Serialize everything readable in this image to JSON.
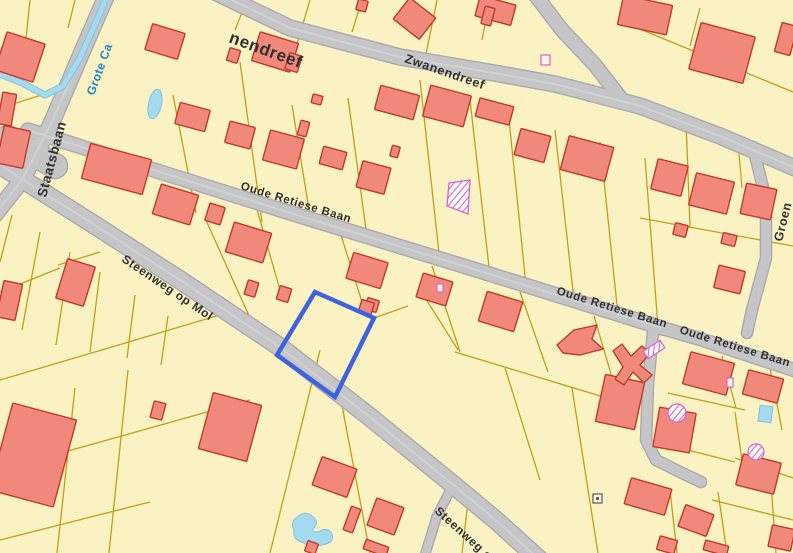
{
  "map": {
    "title": "Cadastral parcel map",
    "colors": {
      "background": "#FAF2C2",
      "parcel_line": "#C59E17",
      "road_fill": "#C5C5C7",
      "road_casing": "#A8A8AB",
      "road_centerline": "#D2D2D4",
      "building_fill": "#F0897B",
      "building_stroke": "#C23A2C",
      "water_fill": "#A5DAEE",
      "water_casing": "#7FC4E4",
      "selection": "#3E63DE",
      "hatch": "#DD5FD0",
      "road_label": "#303030",
      "water_label": "#1E86C8",
      "marker_stroke": "#555555"
    },
    "streets": {
      "names": [
        "Zwanendreef",
        "Staatsbaan",
        "Oude Retiese Baan",
        "Steenweg op Mol",
        "Groen",
        "Grote Ca"
      ],
      "waterway_name": "Grote Ca"
    },
    "roads": [
      {
        "name": "zwanendreef",
        "w": 15,
        "center": true,
        "pts": [
          [
            215,
            -8
          ],
          [
            290,
            28
          ],
          [
            400,
            57
          ],
          [
            500,
            74
          ],
          [
            555,
            84
          ],
          [
            640,
            106
          ],
          [
            720,
            136
          ],
          [
            800,
            170
          ]
        ]
      },
      {
        "name": "zwanendreef-spur",
        "w": 13,
        "center": false,
        "pts": [
          [
            533,
            -8
          ],
          [
            562,
            30
          ],
          [
            595,
            65
          ],
          [
            622,
            100
          ]
        ]
      },
      {
        "name": "staatsbaan",
        "w": 15,
        "center": true,
        "pts": [
          [
            108,
            -8
          ],
          [
            82,
            52
          ],
          [
            52,
            122
          ],
          [
            22,
            180
          ],
          [
            -8,
            218
          ]
        ]
      },
      {
        "name": "oude-retiese-baan-1",
        "w": 13,
        "center": true,
        "pts": [
          [
            28,
            130
          ],
          [
            160,
            172
          ],
          [
            300,
            216
          ],
          [
            470,
            268
          ],
          [
            560,
            296
          ],
          [
            662,
            328
          ]
        ]
      },
      {
        "name": "oude-retiese-baan-2",
        "w": 12,
        "center": false,
        "pts": [
          [
            662,
            328
          ],
          [
            700,
            339
          ],
          [
            800,
            372
          ]
        ]
      },
      {
        "name": "steenweg-op-mol",
        "w": 17,
        "center": true,
        "pts": [
          [
            3,
            167
          ],
          [
            90,
            222
          ],
          [
            180,
            280
          ],
          [
            280,
            347
          ],
          [
            370,
            417
          ],
          [
            445,
            478
          ],
          [
            498,
            522
          ],
          [
            542,
            562
          ]
        ]
      },
      {
        "name": "steenweg-spur",
        "w": 8,
        "center": false,
        "pts": [
          [
            452,
            487
          ],
          [
            437,
            516
          ],
          [
            424,
            558
          ]
        ]
      },
      {
        "name": "groen-road",
        "w": 10,
        "center": false,
        "pts": [
          [
            753,
            147
          ],
          [
            766,
            200
          ],
          [
            766,
            258
          ],
          [
            752,
            310
          ],
          [
            747,
            333
          ]
        ]
      },
      {
        "name": "south-branch",
        "w": 10,
        "center": false,
        "pts": [
          [
            653,
            331
          ],
          [
            648,
            385
          ],
          [
            646,
            440
          ],
          [
            656,
            460
          ],
          [
            680,
            472
          ],
          [
            701,
            482
          ]
        ]
      },
      {
        "name": "junction-patch",
        "w": 24,
        "center": false,
        "pts": [
          [
            8,
            138
          ],
          [
            55,
            166
          ]
        ]
      }
    ],
    "parcel_lines": [
      [
        247,
        0,
        235,
        30
      ],
      [
        310,
        0,
        297,
        44
      ],
      [
        362,
        0,
        352,
        32
      ],
      [
        437,
        0,
        426,
        54
      ],
      [
        490,
        0,
        482,
        40
      ],
      [
        632,
        0,
        624,
        24
      ],
      [
        700,
        8,
        690,
        46
      ],
      [
        618,
        20,
        793,
        92
      ],
      [
        752,
        38,
        745,
        62
      ],
      [
        30,
        0,
        24,
        58
      ],
      [
        75,
        0,
        68,
        28
      ],
      [
        0,
        58,
        26,
        50
      ],
      [
        0,
        108,
        64,
        88
      ],
      [
        173,
        95,
        196,
        213
      ],
      [
        240,
        62,
        262,
        222
      ],
      [
        292,
        105,
        312,
        228
      ],
      [
        348,
        98,
        368,
        244
      ],
      [
        420,
        80,
        440,
        262
      ],
      [
        470,
        100,
        490,
        276
      ],
      [
        508,
        110,
        526,
        285
      ],
      [
        555,
        130,
        574,
        300
      ],
      [
        600,
        142,
        618,
        315
      ],
      [
        645,
        158,
        658,
        327
      ],
      [
        686,
        122,
        690,
        227
      ],
      [
        738,
        142,
        742,
        188
      ],
      [
        640,
        218,
        793,
        246
      ],
      [
        205,
        218,
        250,
        318
      ],
      [
        256,
        206,
        280,
        290
      ],
      [
        340,
        232,
        362,
        302
      ],
      [
        374,
        318,
        408,
        306
      ],
      [
        424,
        296,
        458,
        350
      ],
      [
        432,
        266,
        460,
        352
      ],
      [
        520,
        292,
        548,
        372
      ],
      [
        594,
        316,
        618,
        398
      ],
      [
        455,
        352,
        640,
        408
      ],
      [
        505,
        368,
        540,
        480
      ],
      [
        572,
        388,
        598,
        553
      ],
      [
        668,
        393,
        745,
        410
      ],
      [
        668,
        445,
        735,
        462
      ],
      [
        710,
        358,
        715,
        393
      ],
      [
        735,
        412,
        742,
        460
      ],
      [
        722,
        356,
        736,
        408
      ],
      [
        770,
        368,
        782,
        430
      ],
      [
        712,
        500,
        793,
        520
      ],
      [
        670,
        490,
        677,
        553
      ],
      [
        718,
        492,
        727,
        553
      ],
      [
        770,
        470,
        776,
        553
      ],
      [
        735,
        458,
        793,
        478
      ],
      [
        12,
        215,
        0,
        262
      ],
      [
        40,
        232,
        22,
        330
      ],
      [
        70,
        252,
        56,
        345
      ],
      [
        100,
        272,
        90,
        352
      ],
      [
        135,
        295,
        127,
        358
      ],
      [
        168,
        316,
        161,
        365
      ],
      [
        0,
        380,
        230,
        312
      ],
      [
        0,
        470,
        250,
        400
      ],
      [
        75,
        388,
        57,
        553
      ],
      [
        128,
        370,
        109,
        553
      ],
      [
        320,
        350,
        270,
        553
      ],
      [
        340,
        395,
        370,
        553
      ],
      [
        468,
        502,
        462,
        553
      ],
      [
        0,
        540,
        150,
        502
      ],
      [
        0,
        292,
        60,
        268
      ],
      [
        58,
        265,
        100,
        252
      ]
    ],
    "buildings": [
      [
        148,
        28,
        34,
        27,
        17
      ],
      [
        255,
        37,
        40,
        30,
        17
      ],
      [
        287,
        54,
        13,
        17,
        17
      ],
      [
        228,
        49,
        11,
        13,
        17
      ],
      [
        398,
        5,
        33,
        27,
        38
      ],
      [
        477,
        0,
        37,
        21,
        15
      ],
      [
        620,
        0,
        50,
        30,
        12
      ],
      [
        694,
        29,
        56,
        48,
        15
      ],
      [
        483,
        7,
        10,
        18,
        15
      ],
      [
        778,
        24,
        16,
        30,
        15
      ],
      [
        357,
        0,
        10,
        11,
        15
      ],
      [
        654,
        162,
        31,
        31,
        14
      ],
      [
        692,
        177,
        39,
        33,
        14
      ],
      [
        743,
        186,
        31,
        31,
        12
      ],
      [
        674,
        224,
        13,
        12,
        14
      ],
      [
        722,
        234,
        14,
        11,
        14
      ],
      [
        716,
        268,
        27,
        23,
        14
      ],
      [
        85,
        151,
        63,
        36,
        15
      ],
      [
        177,
        106,
        31,
        22,
        15
      ],
      [
        227,
        124,
        26,
        22,
        15
      ],
      [
        266,
        134,
        35,
        31,
        15
      ],
      [
        321,
        149,
        24,
        18,
        15
      ],
      [
        359,
        164,
        29,
        27,
        15
      ],
      [
        299,
        121,
        9,
        15,
        15
      ],
      [
        391,
        146,
        8,
        11,
        15
      ],
      [
        312,
        95,
        10,
        9,
        15
      ],
      [
        377,
        90,
        40,
        25,
        15
      ],
      [
        426,
        90,
        42,
        32,
        15
      ],
      [
        477,
        102,
        35,
        19,
        15
      ],
      [
        517,
        132,
        31,
        27,
        15
      ],
      [
        564,
        141,
        46,
        35,
        15
      ],
      [
        156,
        189,
        39,
        31,
        17
      ],
      [
        207,
        205,
        16,
        18,
        17
      ],
      [
        229,
        227,
        39,
        31,
        17
      ],
      [
        246,
        281,
        11,
        15,
        17
      ],
      [
        349,
        257,
        36,
        27,
        17
      ],
      [
        366,
        299,
        12,
        12,
        17
      ],
      [
        419,
        277,
        31,
        25,
        17
      ],
      [
        482,
        296,
        37,
        31,
        17
      ],
      [
        600,
        378,
        40,
        48,
        12
      ],
      [
        686,
        357,
        45,
        33,
        15
      ],
      [
        745,
        374,
        36,
        25,
        15
      ],
      [
        656,
        410,
        37,
        40,
        10
      ],
      [
        739,
        458,
        39,
        32,
        14
      ],
      [
        627,
        483,
        42,
        27,
        16
      ],
      [
        681,
        509,
        30,
        23,
        20
      ],
      [
        658,
        538,
        18,
        14,
        16
      ],
      [
        704,
        543,
        24,
        10,
        15
      ],
      [
        770,
        527,
        23,
        22,
        12
      ],
      [
        205,
        398,
        50,
        58,
        15
      ],
      [
        152,
        402,
        12,
        17,
        15
      ],
      [
        316,
        462,
        37,
        30,
        20
      ],
      [
        347,
        507,
        10,
        25,
        20
      ],
      [
        371,
        502,
        29,
        29,
        20
      ],
      [
        364,
        543,
        24,
        10,
        20
      ],
      [
        306,
        542,
        11,
        11,
        20
      ],
      [
        0,
        37,
        40,
        40,
        18
      ],
      [
        0,
        128,
        27,
        38,
        12
      ],
      [
        61,
        262,
        29,
        41,
        17
      ],
      [
        0,
        282,
        19,
        37,
        12
      ],
      [
        0,
        410,
        66,
        90,
        15
      ],
      [
        0,
        93,
        14,
        32,
        10
      ],
      [
        278,
        287,
        12,
        14,
        17
      ],
      [
        360,
        301,
        13,
        12,
        17
      ]
    ],
    "building_polys": [
      {
        "name": "arrow-building",
        "points": "557,345 574,330 597,325 592,339 603,349 580,355 563,353"
      },
      {
        "name": "windmill-building",
        "points": "613,351 622,344 631,356 642,346 650,353 640,365 652,375 644,383 633,372 624,385 615,379 623,367"
      }
    ],
    "hatched_features": [
      {
        "type": "poly",
        "points": "449,183 470,180 468,214 447,206"
      },
      {
        "type": "rect",
        "x": 644,
        "y": 345,
        "w": 20,
        "h": 9,
        "rot": -33
      },
      {
        "type": "circle",
        "cx": 677,
        "cy": 413,
        "r": 9
      },
      {
        "type": "circle",
        "cx": 756,
        "cy": 452,
        "r": 8
      }
    ],
    "magenta_small": [
      [
        541,
        55,
        9,
        10
      ],
      [
        437,
        284,
        6,
        8
      ],
      [
        727,
        378,
        6,
        9
      ]
    ],
    "markers": [
      [
        593,
        494,
        9,
        9
      ]
    ],
    "water": {
      "streams": [
        [
          [
            108,
            -6
          ],
          [
            96,
            22
          ],
          [
            80,
            58
          ],
          [
            63,
            86
          ],
          [
            45,
            95
          ],
          [
            20,
            82
          ],
          [
            -6,
            72
          ]
        ]
      ],
      "pond_ellipse": {
        "cx": 155,
        "cy": 104,
        "rx": 6.5,
        "ry": 15,
        "rot": 12
      },
      "pool_rect": {
        "x": 759,
        "y": 406,
        "w": 13,
        "h": 16,
        "rot": 8
      },
      "pond_blob": "M297 517 Q305 510 312 516 Q320 522 314 528 Q310 532 318 532 Q328 526 332 534 Q335 543 322 545 Q310 548 304 543 Q292 540 294 530 Q290 522 297 517 Z"
    },
    "selected_parcel": {
      "points": "315,292 374,318 335,397 277,355",
      "stroke_width": 4.5
    },
    "labels": [
      {
        "text": "nendreef",
        "x": 228,
        "y": 42,
        "rot": 20,
        "size": 17,
        "kind": "road"
      },
      {
        "text": "Zwanendreef",
        "x": 404,
        "y": 62,
        "rot": 19,
        "size": 12.5,
        "kind": "road"
      },
      {
        "text": "Oude Retiese Baan",
        "x": 240,
        "y": 189,
        "rot": 17,
        "size": 11.5,
        "kind": "road"
      },
      {
        "text": "Oude Retiese Baan",
        "x": 556,
        "y": 294,
        "rot": 17,
        "size": 11.5,
        "kind": "road"
      },
      {
        "text": "Oude Retiese Baan",
        "x": 679,
        "y": 333,
        "rot": 17,
        "size": 11.5,
        "kind": "road"
      },
      {
        "text": "Steenweg op Mol",
        "x": 121,
        "y": 261,
        "rot": 34,
        "size": 12,
        "kind": "road"
      },
      {
        "text": "Steenweg op",
        "x": 434,
        "y": 512,
        "rot": 42,
        "size": 12,
        "kind": "road"
      },
      {
        "text": "Staatsbaan",
        "x": 46,
        "y": 198,
        "rot": -75,
        "size": 13.5,
        "kind": "road"
      },
      {
        "text": "Groen",
        "x": 782,
        "y": 242,
        "rot": -76,
        "size": 12.5,
        "kind": "road"
      },
      {
        "text": "Grote Ca",
        "x": 94,
        "y": 96,
        "rot": -70,
        "size": 12,
        "kind": "water"
      }
    ]
  }
}
